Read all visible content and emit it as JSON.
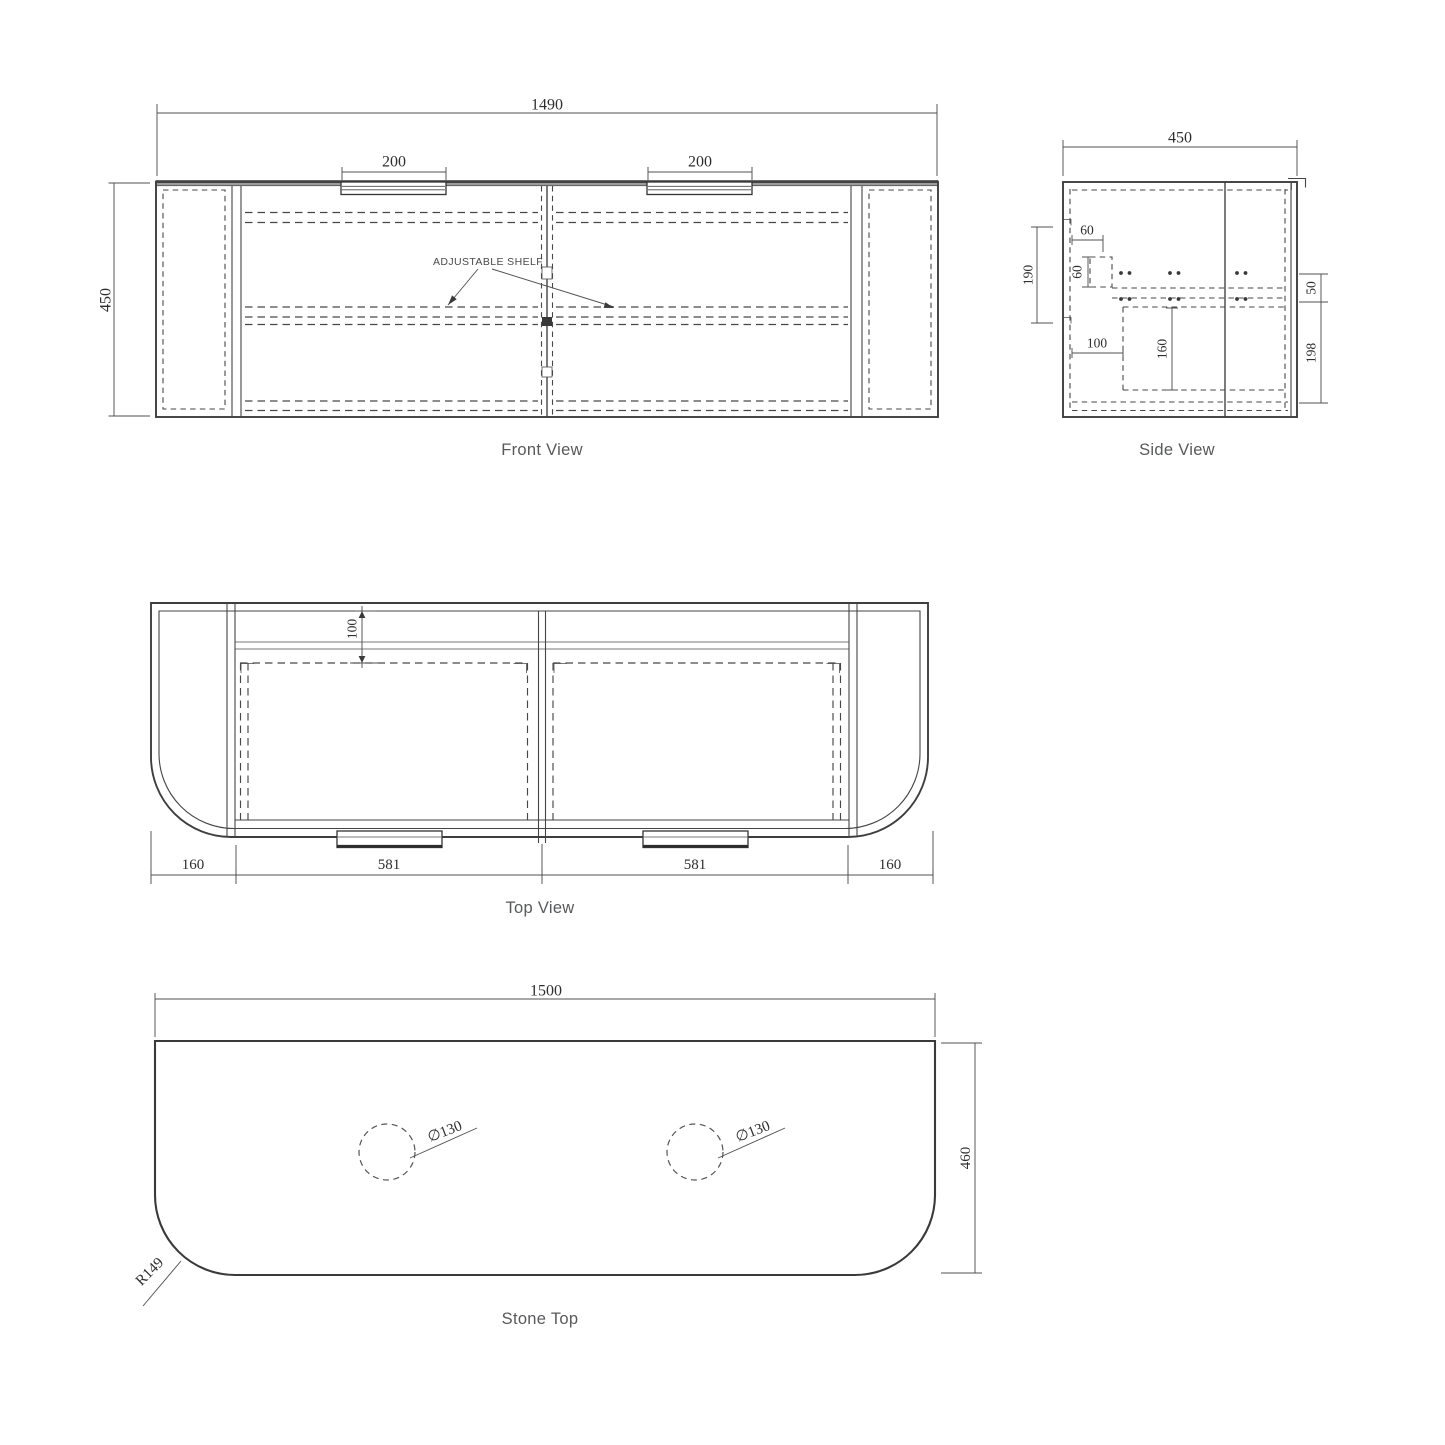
{
  "drawing": {
    "background": "#ffffff",
    "line_color": "#3e3e3e",
    "dim_text_color": "#2e2e2e",
    "label_color": "#58595b"
  },
  "front": {
    "title": "Front View",
    "note": "ADJUSTABLE SHELF",
    "dim_width": "1490",
    "dim_height": "450",
    "dim_handle_left": "200",
    "dim_handle_right": "200"
  },
  "side": {
    "title": "Side View",
    "dim_depth": "450",
    "dim_hang_height": "190",
    "dim_top_inset": "60",
    "dim_rail_height": "60",
    "dim_back_clearance": "100",
    "dim_drawer_depth": "160",
    "dim_gap": "50",
    "dim_drawer_face": "198"
  },
  "top": {
    "title": "Top View",
    "dim_back_rail": "100",
    "dim_left_end": "160",
    "dim_drawer_left": "581",
    "dim_drawer_right": "581",
    "dim_right_end": "160"
  },
  "stone": {
    "title": "Stone Top",
    "dim_width": "1500",
    "dim_depth": "460",
    "dim_corner_radius": "R149",
    "dim_hole_left": "∅130",
    "dim_hole_right": "∅130"
  }
}
